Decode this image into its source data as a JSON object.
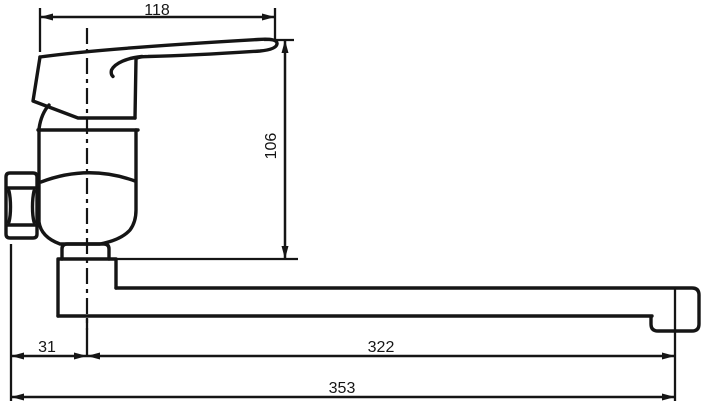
{
  "page": {
    "background": "#ffffff"
  },
  "drawing": {
    "type": "technical-drawing",
    "subject": "Wall-mounted single-lever mixer tap, side view with dimensions",
    "line_color": "#151515",
    "units": "mm",
    "dimensions": [
      {
        "id": "handle-projection",
        "label": "118",
        "orientation": "horizontal"
      },
      {
        "id": "overall-height",
        "label": "106",
        "orientation": "vertical"
      },
      {
        "id": "wall-to-axis",
        "label": "31",
        "orientation": "horizontal"
      },
      {
        "id": "axis-to-spout-end",
        "label": "322",
        "orientation": "horizontal"
      },
      {
        "id": "overall-length",
        "label": "353",
        "orientation": "horizontal"
      }
    ]
  }
}
